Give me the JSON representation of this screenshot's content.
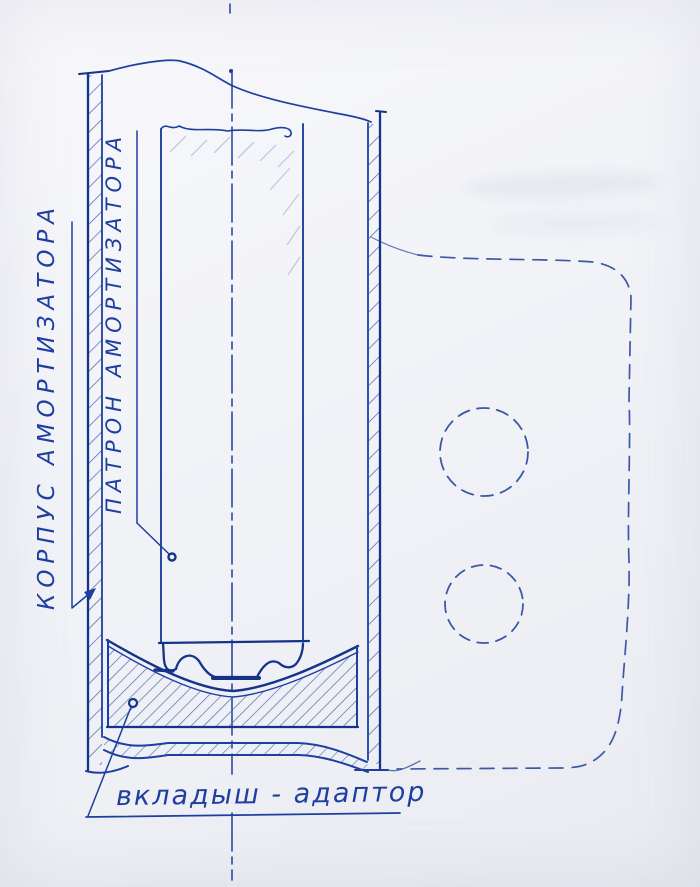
{
  "labels": {
    "body": "КОРПУС АМОРТИЗАТОРА",
    "cartridge": "ПАТРОН АМОРТИЗАТОРА",
    "insert_adapter": "вкладыш - адаптор"
  },
  "colors": {
    "ink": "#1e3f9f",
    "ink_dark": "#16338a",
    "hatch": "#4e6cb8",
    "hatch_light": "#93a7d6",
    "phantom": "#3c59a8",
    "paper": "#f2f3f7"
  }
}
